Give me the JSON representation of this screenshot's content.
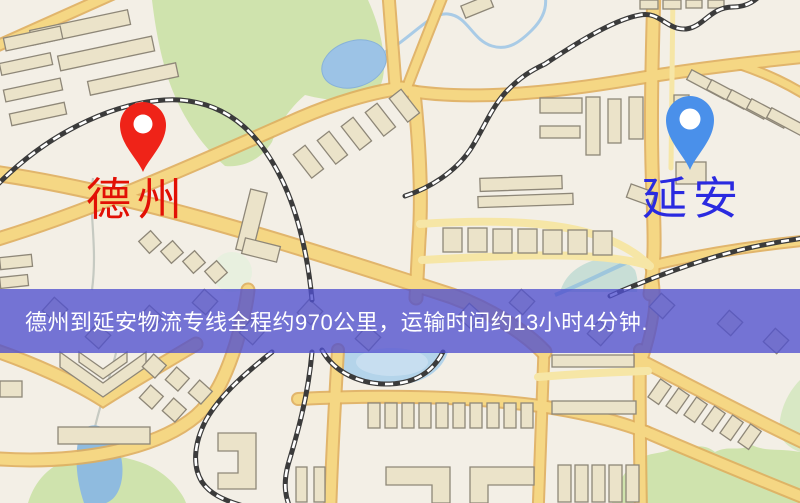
{
  "markers": {
    "origin": {
      "label": "德州",
      "label_color": "#e21005",
      "pin_color": "#ef2318",
      "pin_style": "red-pin"
    },
    "destination": {
      "label": "延安",
      "label_color": "#2a2ae0",
      "pin_color": "#4a90ea",
      "pin_style": "blue-pin"
    }
  },
  "banner": {
    "text": "德州到延安物流专线全程约970公里，运输时间约13小时4分钟.",
    "overlay_color": "rgba(79,79,206,0.78)",
    "text_color": "#ffffff"
  },
  "route": {
    "from": "德州",
    "to": "延安",
    "distance_km": "970",
    "duration": "13小时4分钟"
  },
  "palette": {
    "background": "#f3efe6",
    "road_major": "#f5d784",
    "road_minor": "#f6e6a6",
    "road_casing": "#dfae5e",
    "building": "#ebe3c9",
    "building_outline": "#8e8778",
    "park": "#cfe3ad",
    "water": "#9cc3e6",
    "lake": "#b4d4ea",
    "railway": "#3b3b3b"
  }
}
